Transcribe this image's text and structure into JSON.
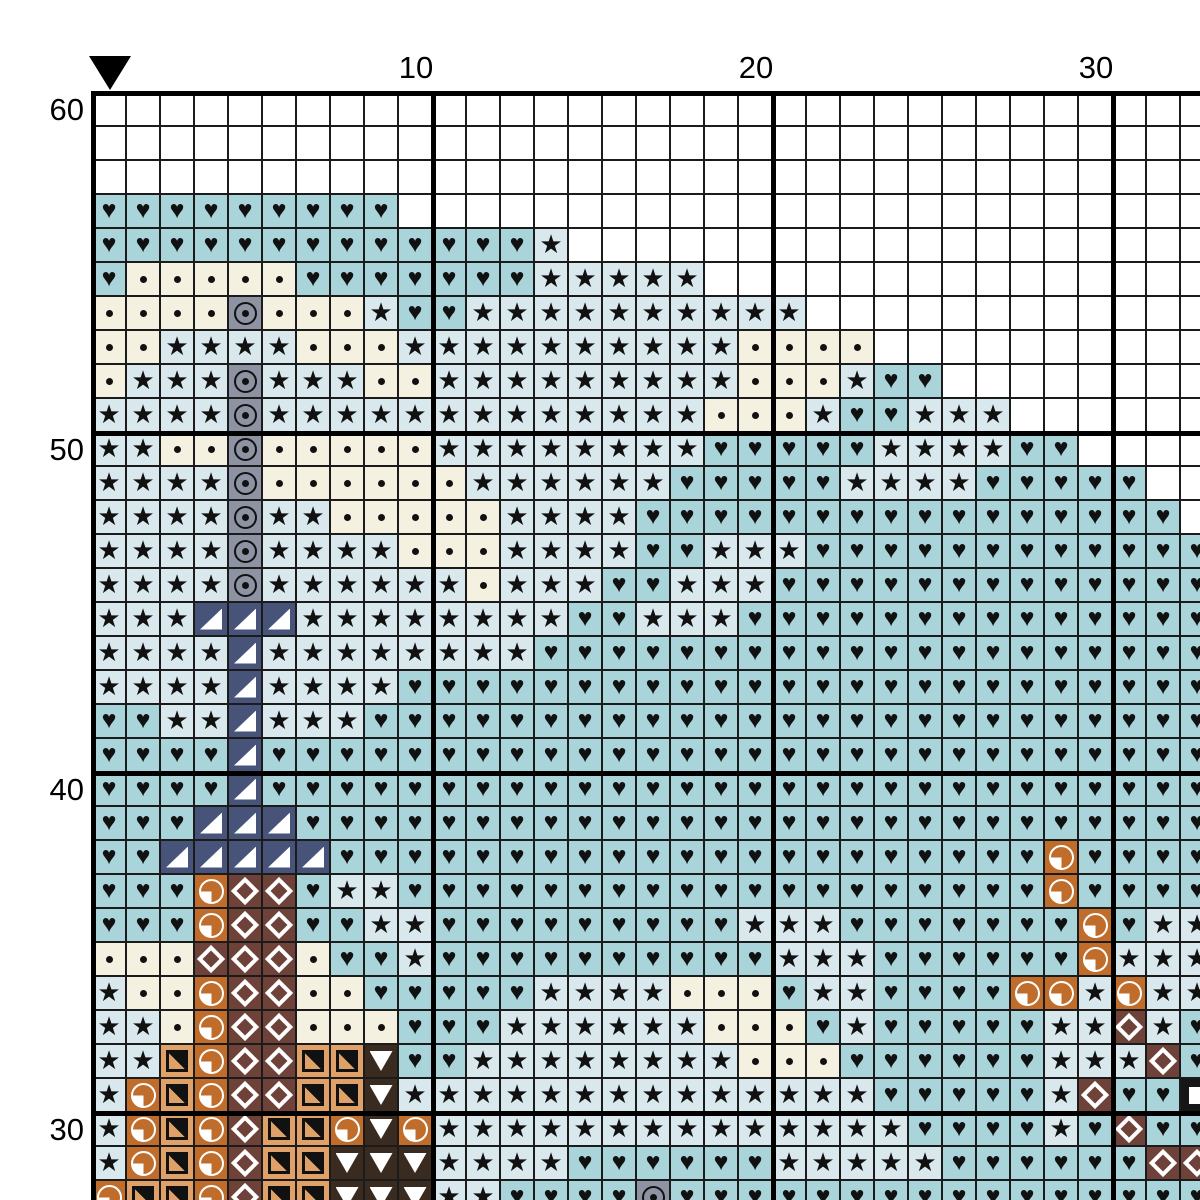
{
  "chart_title": "Cross-stitch pattern chart (detail view)",
  "ruler": {
    "column_labels": [
      {
        "label": "10",
        "col": 10
      },
      {
        "label": "20",
        "col": 20
      },
      {
        "label": "30",
        "col": 30
      }
    ],
    "row_labels": [
      {
        "label": "60",
        "row": 60
      },
      {
        "label": "50",
        "row": 50
      },
      {
        "label": "40",
        "row": 40
      },
      {
        "label": "30",
        "row": 30
      }
    ],
    "marker_col": 1
  },
  "palette": {
    "w": {
      "name": "empty-cell",
      "bg": "#ffffff",
      "symbol": null,
      "symbol_class": null
    },
    "s": {
      "name": "star-icon",
      "bg": "#d8e8ec",
      "symbol": "black star",
      "symbol_class": "sym-star",
      "glyph": "★"
    },
    "d": {
      "name": "dot-icon",
      "bg": "#f5f1e0",
      "symbol": "black dot",
      "symbol_class": "sym-dot"
    },
    "h": {
      "name": "heart-icon",
      "bg": "#a9d4d9",
      "symbol": "black heart",
      "symbol_class": "sym-heart",
      "glyph": "♥"
    },
    "g": {
      "name": "circled-dot-icon",
      "bg": "#8d93a2",
      "symbol": "black circled dot",
      "symbol_class": "sym-ring"
    },
    "n": {
      "name": "corner-triangle-icon",
      "bg": "#475379",
      "symbol": "white lower-right triangle",
      "symbol_class": "sym-corner-tri"
    },
    "b": {
      "name": "diamond-icon",
      "bg": "#6e4238",
      "symbol": "white diamond outline",
      "symbol_class": "sym-diamond"
    },
    "o": {
      "name": "quarter-circle-icon",
      "bg": "#c06d2b",
      "symbol": "white circle with filled quarter",
      "symbol_class": "sym-pie"
    },
    "q": {
      "name": "half-square-icon",
      "bg": "#e0a169",
      "symbol": "black square with diagonal half",
      "symbol_class": "sym-halfsq"
    },
    "k": {
      "name": "down-triangle-icon",
      "bg": "#3a2b20",
      "symbol": "white down triangle",
      "symbol_class": "sym-downtri"
    },
    "x": {
      "name": "white-square-icon",
      "bg": "#161616",
      "symbol": "white filled square",
      "symbol_class": "sym-wsquare"
    }
  },
  "grid": {
    "first_col": 1,
    "cols": 33,
    "cell_px": 34,
    "origin_px": {
      "x": 93,
      "y": 93
    },
    "major_line_every": 10,
    "rows": [
      {
        "row": 60,
        "cells": "wwwwwwwwwwwwwwwwwwwwwwwwwwwwwwwww"
      },
      {
        "row": 59,
        "cells": "wwwwwwwwwwwwwwwwwwwwwwwwwwwwwwwww"
      },
      {
        "row": 58,
        "cells": "wwwwwwwwwwwwwwwwwwwwwwwwwwwwwwwww"
      },
      {
        "row": 57,
        "cells": "hhhhhhhhhwwwwwwwwwwwwwwwwwwwwwwww"
      },
      {
        "row": 56,
        "cells": "hhhhhhhhhhhhhswwwwwwwwwwwwwwwwwww"
      },
      {
        "row": 55,
        "cells": "hdddddhhhhhhhssssswwwwwwwwwwwwwww"
      },
      {
        "row": 54,
        "cells": "ddddgdddshhsssssssssswwwwwwwwwwww"
      },
      {
        "row": 53,
        "cells": "ddssssdddssssssssssddddwwwwwwwwww"
      },
      {
        "row": 52,
        "cells": "dsssgsssddsssssssssdddshhwwwwwwww"
      },
      {
        "row": 51,
        "cells": "ssssgsssssssssssssdddshhssswwwwww"
      },
      {
        "row": 50,
        "cells": "ssddgdddddsssssssshhhhhsssshhwwww"
      },
      {
        "row": 49,
        "cells": "ssssgddddddsssssshhhhhsssshhhhhww"
      },
      {
        "row": 48,
        "cells": "ssssgssdddddsssshhhhhhhhhhhhhhhhw"
      },
      {
        "row": 47,
        "cells": "ssssgssssdddsssshhssshhhhhhhhhhhh"
      },
      {
        "row": 46,
        "cells": "ssssgssssssdssshhssshhhhhhhhhhhhh"
      },
      {
        "row": 45,
        "cells": "sssnnnsssssssshhssshhhhhhhhhhhhhh"
      },
      {
        "row": 44,
        "cells": "ssssnsssssssshhhhhhhhhhhhhhhhhhhh"
      },
      {
        "row": 43,
        "cells": "ssssnsssshhhhhhhhhhhhhhhhhhhhhhhh"
      },
      {
        "row": 42,
        "cells": "hhssnssshhhhhhhhhhhhhhhhhhhhhhhhh"
      },
      {
        "row": 41,
        "cells": "hhhhnhhhhhhhhhhhhhhhhhhhhhhhhhhhh"
      },
      {
        "row": 40,
        "cells": "hhhhnhhhhhhhhhhhhhhhhhhhhhhhhhhhh"
      },
      {
        "row": 39,
        "cells": "hhhnnnhhhhhhhhhhhhhhhhhhhhhhhhhhh"
      },
      {
        "row": 38,
        "cells": "hhnnnnnhhhhhhhhhhhhhhhhhhhhhohhhh"
      },
      {
        "row": 37,
        "cells": "hhhobbhsshhhhhhhhhhhhhhhhhhhohhhh"
      },
      {
        "row": 36,
        "cells": "hhhobbhhsshhhhhhhhhssshhhhhhhohss"
      },
      {
        "row": 35,
        "cells": "dddbbbdhhshhhhhhhhhhssshhhhhhosss"
      },
      {
        "row": 34,
        "cells": "sddobbddhhhhhssssdddhsshhhhoososs"
      },
      {
        "row": 33,
        "cells": "ssdobbdddhhhssssssdddhshhhhhssbsh"
      },
      {
        "row": 32,
        "cells": "ssqobbqqkhhssssssssdddhhhhhhsssbh"
      },
      {
        "row": 31,
        "cells": "soqobbqqksssssssssssssshhhhhsbhhx"
      },
      {
        "row": 30,
        "cells": "soqobqqokosssssssssssssshhhhshbhh"
      },
      {
        "row": 29,
        "cells": "soqobqqkkksssshhhhhhssssshhhhhhbb"
      },
      {
        "row": 28,
        "cells": "oqqobqqkkksshhhhghhhhhhhhhhhhhhhh"
      }
    ]
  },
  "colors": {
    "page_bg": "#ffffff",
    "thin_grid_line": "#1b1b1b",
    "major_grid_line": "#000000",
    "symbol_dark": "#111111",
    "symbol_light": "#ffffff",
    "label_text": "#000000"
  }
}
